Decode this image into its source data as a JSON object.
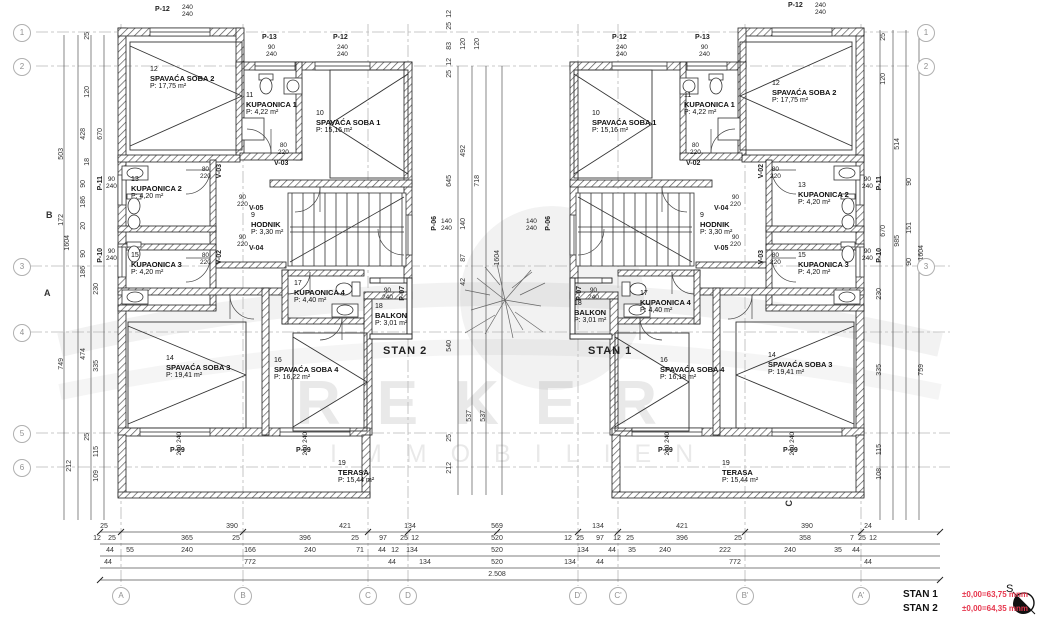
{
  "watermark": {
    "line1": "REKER",
    "line2": "IMMOBILIEN"
  },
  "legend": {
    "stan1": "STAN 1",
    "stan1_level": "±0,00=63,75 mnm",
    "stan2": "STAN 2",
    "stan2_level": "±0,00=64,35 mnm",
    "north": "S"
  },
  "grid": {
    "rows_left": [
      "1",
      "2",
      "3",
      "4",
      "5",
      "6"
    ],
    "rows_right": [
      "1",
      "2",
      "3"
    ],
    "cols": [
      "A",
      "B",
      "C",
      "D",
      "D'",
      "C'",
      "B'",
      "A'"
    ]
  },
  "sections": {
    "b": "B",
    "a": "A",
    "c": "C"
  },
  "stan2": {
    "label": "STAN 2",
    "rooms": [
      {
        "num": "12",
        "name": "SPAVAĆA SOBA 2",
        "area": "P: 17,75 m²"
      },
      {
        "num": "11",
        "name": "KUPAONICA 1",
        "area": "P: 4,22 m²"
      },
      {
        "num": "10",
        "name": "SPAVAĆA SOBA 1",
        "area": "P: 15,16 m²"
      },
      {
        "num": "13",
        "name": "KUPAONICA 2",
        "area": "P: 4,20 m²"
      },
      {
        "num": "15",
        "name": "KUPAONICA 3",
        "area": "P: 4,20 m²"
      },
      {
        "num": "9",
        "name": "HODNIK",
        "area": "P: 3,30 m²"
      },
      {
        "num": "17",
        "name": "KUPAONICA 4",
        "area": "P: 4,40 m²"
      },
      {
        "num": "18",
        "name": "BALKON",
        "area": "P: 3,01 m²"
      },
      {
        "num": "14",
        "name": "SPAVAĆA SOBA 3",
        "area": "P: 19,41 m²"
      },
      {
        "num": "16",
        "name": "SPAVAĆA SOBA 4",
        "area": "P: 16,22 m²"
      },
      {
        "num": "19",
        "name": "TERASA",
        "area": "P: 15,44 m²"
      }
    ]
  },
  "stan1": {
    "label": "STAN 1",
    "rooms": [
      {
        "num": "10",
        "name": "SPAVAĆA SOBA 1",
        "area": "P: 15,16 m²"
      },
      {
        "num": "11",
        "name": "KUPAONICA 1",
        "area": "P: 4,22 m²"
      },
      {
        "num": "12",
        "name": "SPAVAĆA SOBA 2",
        "area": "P: 17,75 m²"
      },
      {
        "num": "13",
        "name": "KUPAONICA 2",
        "area": "P: 4,20 m²"
      },
      {
        "num": "15",
        "name": "KUPAONICA 3",
        "area": "P: 4,20 m²"
      },
      {
        "num": "9",
        "name": "HODNIK",
        "area": "P: 3,30 m²"
      },
      {
        "num": "17",
        "name": "KUPAONICA 4",
        "area": "P: 4,40 m²"
      },
      {
        "num": "18",
        "name": "BALKON",
        "area": "P: 3,01 m²"
      },
      {
        "num": "14",
        "name": "SPAVAĆA SOBA 3",
        "area": "P: 19,41 m²"
      },
      {
        "num": "16",
        "name": "SPAVAĆA SOBA 4",
        "area": "P: 16,18 m²"
      },
      {
        "num": "19",
        "name": "TERASA",
        "area": "P: 15,44 m²"
      }
    ]
  },
  "ptags": [
    {
      "id": "P-12",
      "size": "240\n240"
    },
    {
      "id": "P-13",
      "size": "90\n240"
    },
    {
      "id": "P-12",
      "size": "240\n240"
    },
    {
      "id": "P-12",
      "size": "240\n240"
    },
    {
      "id": "P-13",
      "size": "90\n240"
    },
    {
      "id": "P-12",
      "size": "240\n240"
    },
    {
      "id": "P-11",
      "size": "90\n240"
    },
    {
      "id": "P-10",
      "size": "90\n240"
    },
    {
      "id": "P-11",
      "size": "90\n240"
    },
    {
      "id": "P-10",
      "size": "90\n240"
    },
    {
      "id": "P-09",
      "size": "240 240"
    },
    {
      "id": "P-09",
      "size": "240 240"
    },
    {
      "id": "P-09",
      "size": "240 240"
    },
    {
      "id": "P-09",
      "size": "240 240"
    },
    {
      "id": "P-07",
      "size": "90\n240"
    },
    {
      "id": "P-07",
      "size": "90\n240"
    },
    {
      "id": "P-06",
      "size": "140\n240"
    },
    {
      "id": "P-06",
      "size": "140\n240"
    }
  ],
  "vtags": [
    {
      "id": "V-03",
      "size": "80\n220"
    },
    {
      "id": "V-02",
      "size": "80\n220"
    },
    {
      "id": "V-05",
      "size": "90\n220"
    },
    {
      "id": "V-04",
      "size": "90\n220"
    },
    {
      "id": "V-03",
      "size": "80\n220"
    },
    {
      "id": "V-02",
      "size": "80\n220"
    },
    {
      "id": "V-04",
      "size": "90\n220"
    },
    {
      "id": "V-05",
      "size": "90\n220"
    },
    {
      "id": "V-02",
      "size": "80\n220"
    },
    {
      "id": "V-03",
      "size": "80\n220"
    }
  ],
  "dims": {
    "bottom": [
      [
        "25",
        "390",
        "421",
        "134",
        "569",
        "134",
        "421",
        "390",
        "24"
      ],
      [
        "12",
        "25",
        "365",
        "25",
        "396",
        "25",
        "97",
        "25",
        "12",
        "520",
        "12",
        "25",
        "97",
        "12",
        "25",
        "396",
        "25",
        "358",
        "7",
        "25",
        "12"
      ],
      [
        "44",
        "55",
        "240",
        "166",
        "240",
        "71",
        "44",
        "12",
        "134",
        "520",
        "134",
        "44",
        "35",
        "240",
        "222",
        "240",
        "35",
        "44"
      ],
      [
        "44",
        "772",
        "44",
        "134",
        "520",
        "134",
        "44",
        "772",
        "44"
      ],
      [
        "2.508"
      ]
    ],
    "left": [
      "25",
      "120",
      "503",
      "428",
      "18",
      "670",
      "90",
      "186",
      "172",
      "20",
      "1604",
      "90",
      "186",
      "230",
      "474",
      "335",
      "749",
      "25",
      "115",
      "212",
      "109"
    ],
    "right": [
      "25",
      "120",
      "514",
      "670",
      "985",
      "90",
      "151",
      "90",
      "1604",
      "230",
      "335",
      "115",
      "108",
      "759"
    ],
    "center": [
      "12",
      "25",
      "83",
      "120",
      "120",
      "12",
      "25",
      "492",
      "645",
      "718",
      "140",
      "87",
      "1604",
      "540",
      "537",
      "537",
      "25",
      "212",
      "42"
    ]
  }
}
